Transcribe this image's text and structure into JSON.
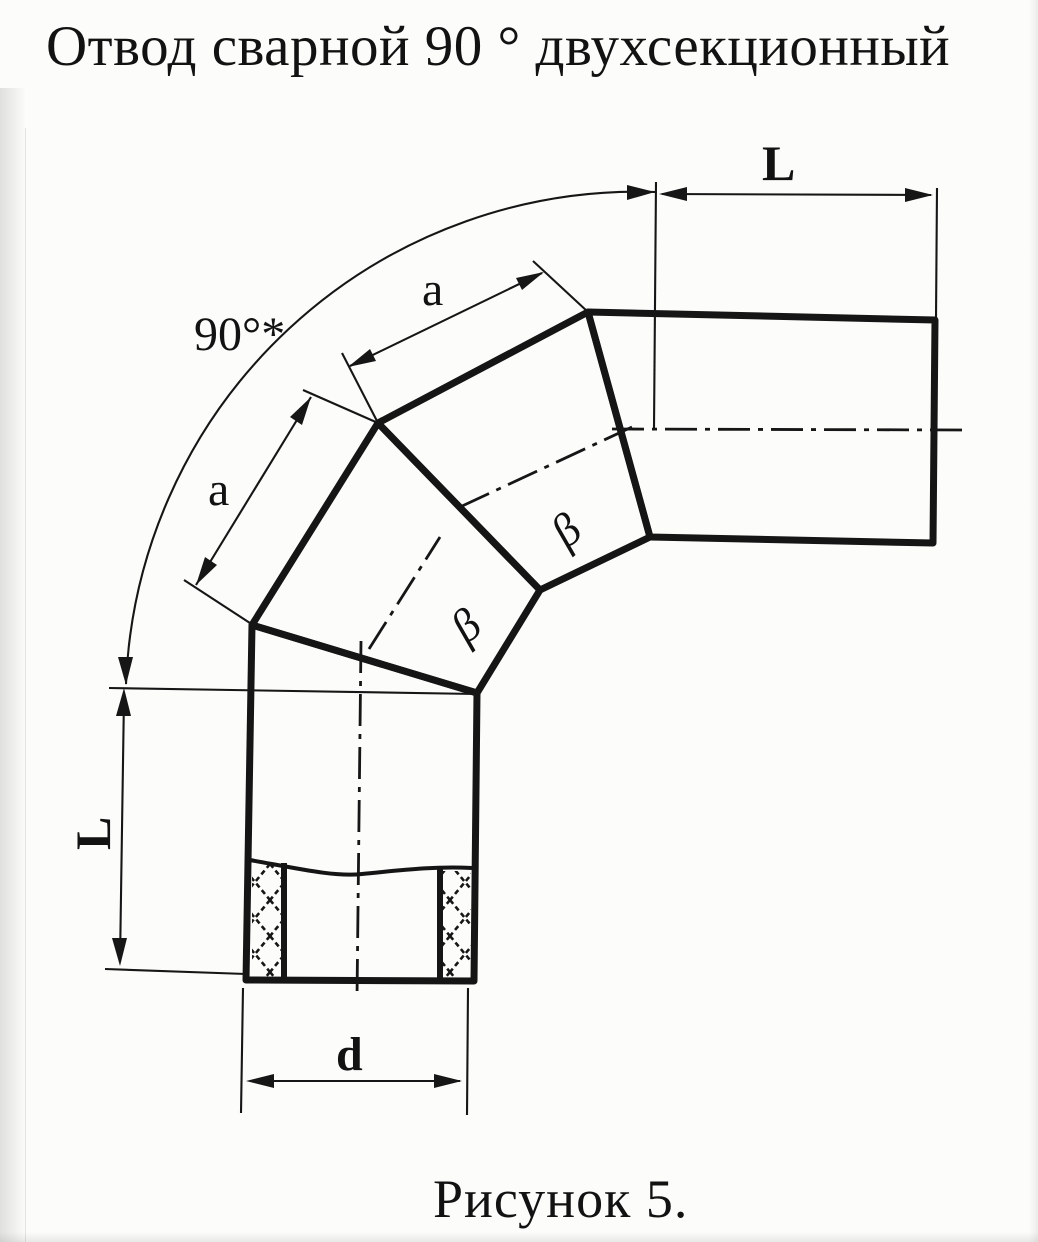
{
  "page": {
    "title": "Отвод сварной 90 ° двухсекционный",
    "caption": "Рисунок 5."
  },
  "colors": {
    "ink": "#161616",
    "paper": "#fcfcfa"
  },
  "labels": {
    "length_top": "L",
    "length_left": "L",
    "section_upper": "a",
    "section_lower": "a",
    "angle": "90°*",
    "diameter": "d",
    "bevel_upper": "β",
    "bevel_lower": "β"
  }
}
